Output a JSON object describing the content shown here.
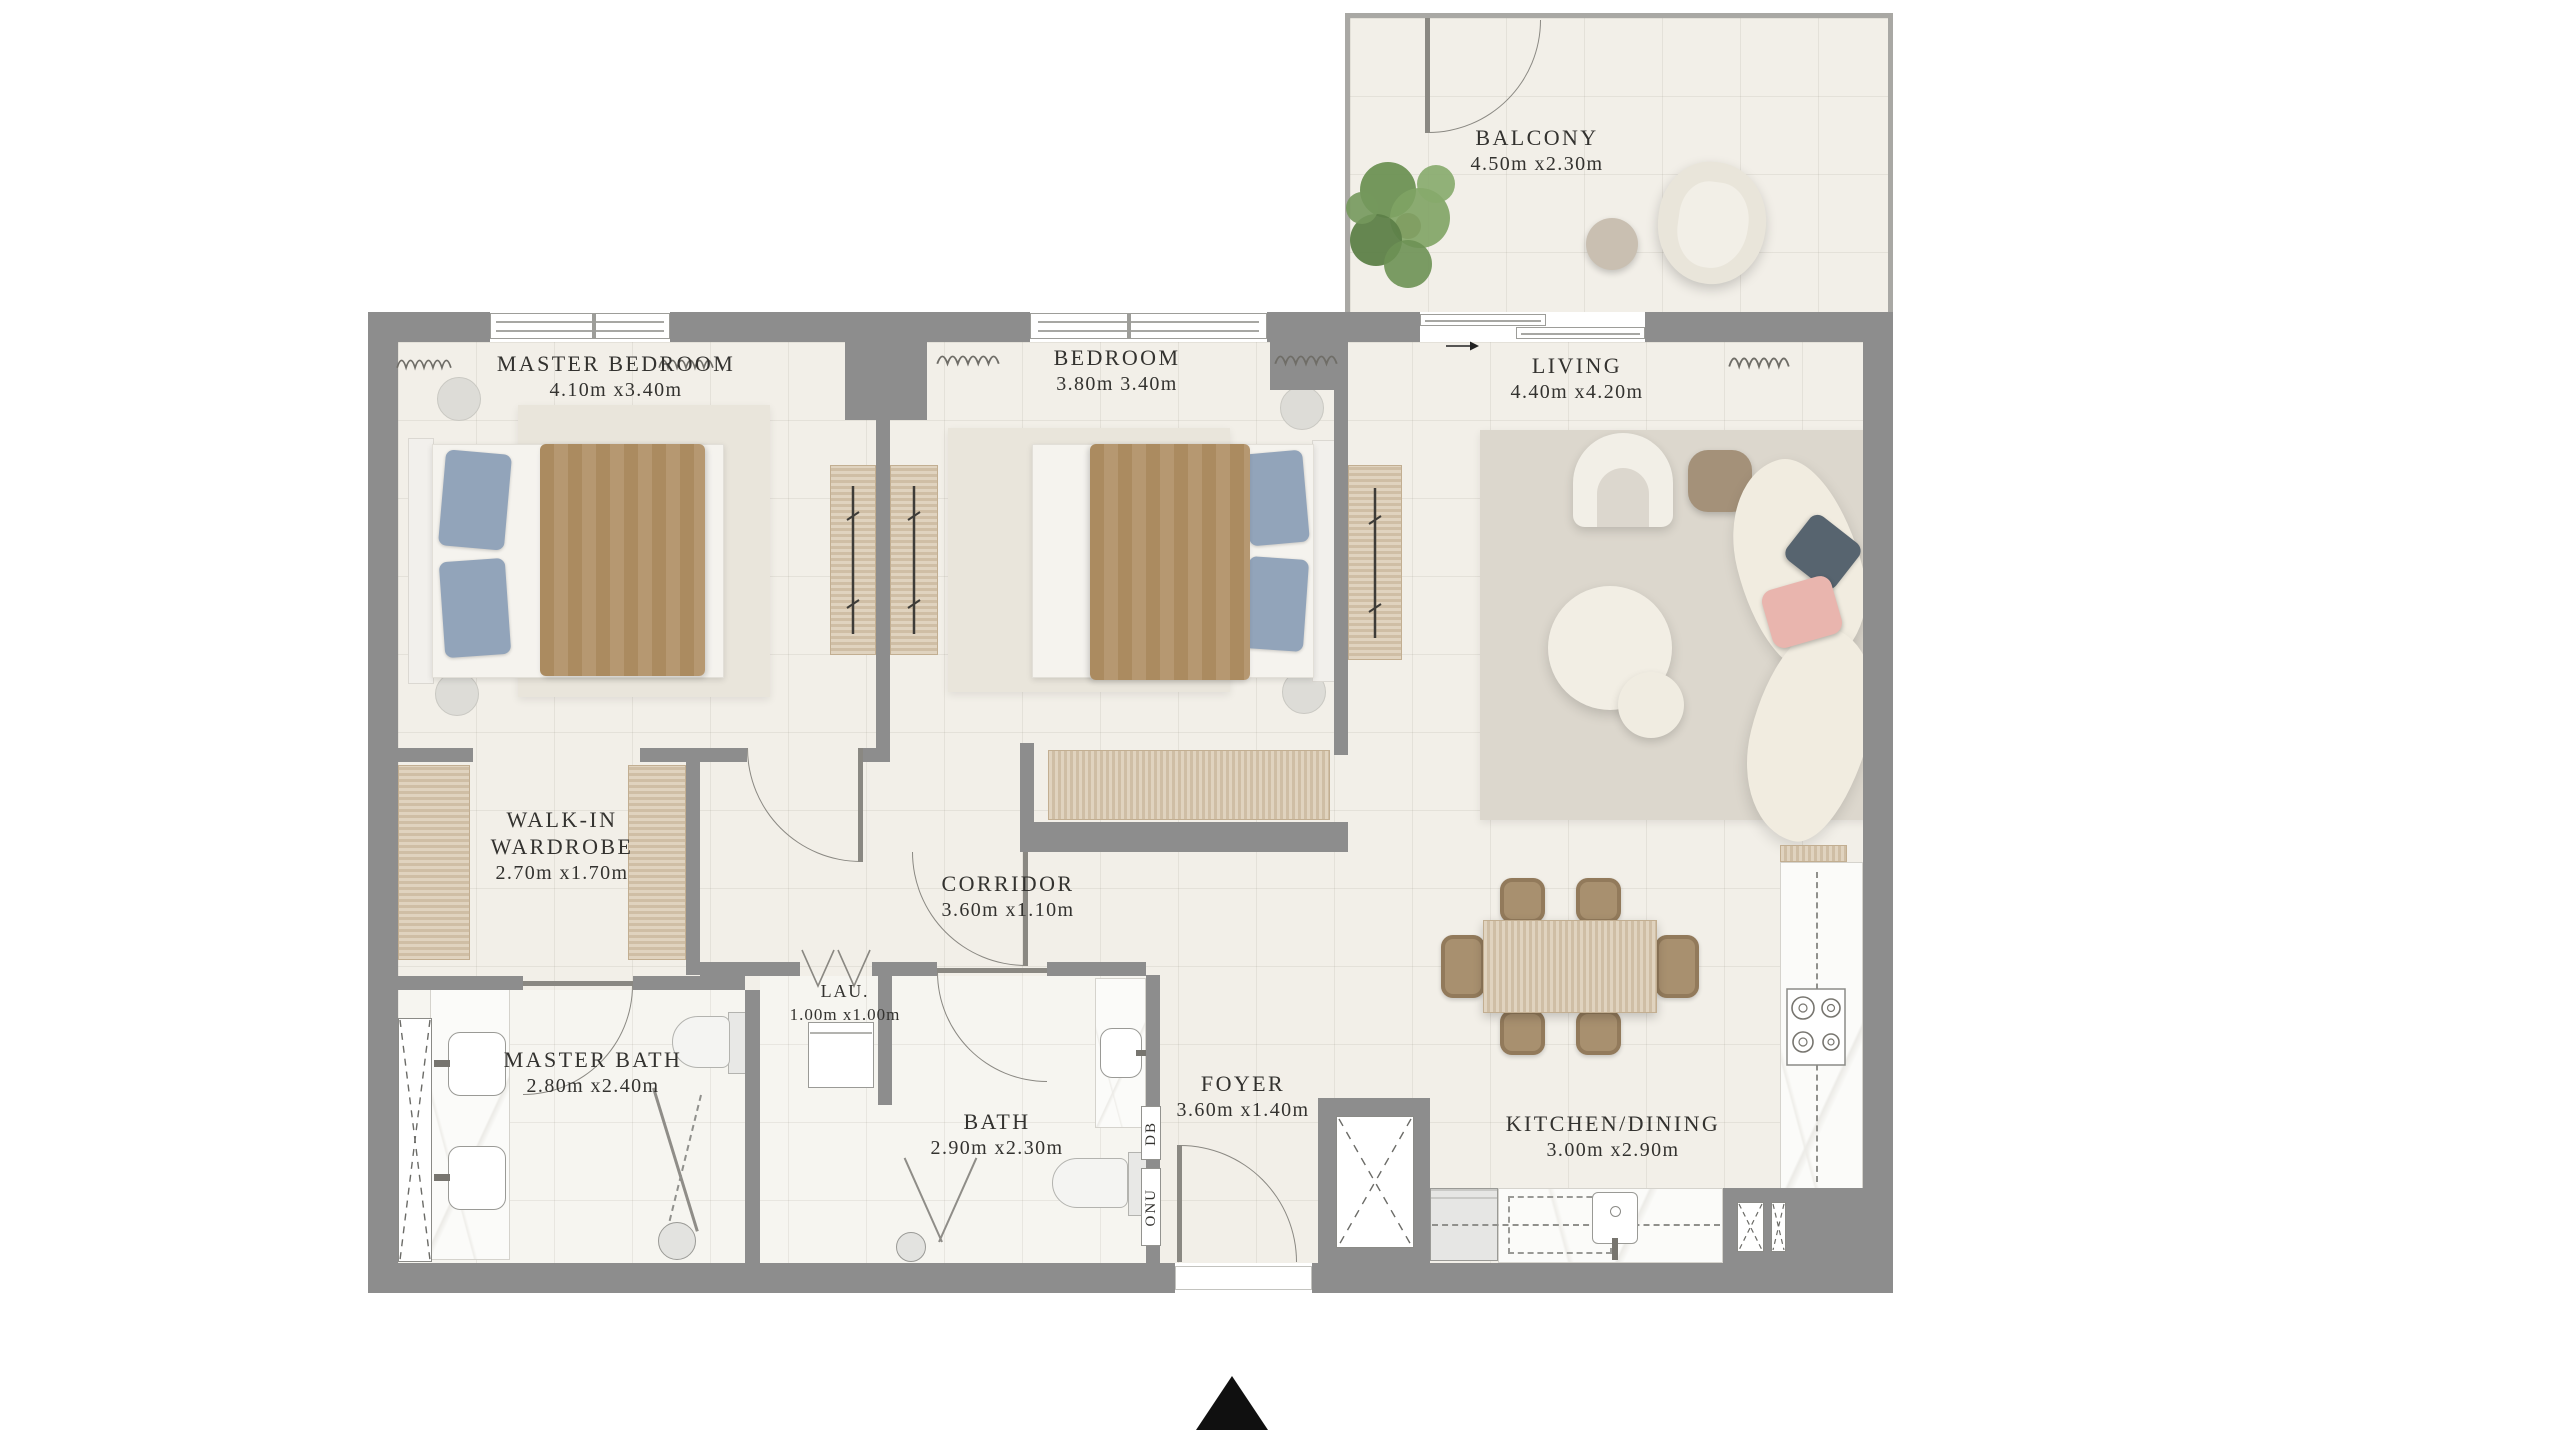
{
  "plan": {
    "title": "Apartment floor plan",
    "rooms": [
      {
        "id": "master-bedroom",
        "name": "MASTER BEDROOM",
        "dims": "4.10m x3.40m"
      },
      {
        "id": "bedroom",
        "name": "BEDROOM",
        "dims": "3.80m 3.40m"
      },
      {
        "id": "living",
        "name": "LIVING",
        "dims": "4.40m x4.20m"
      },
      {
        "id": "balcony",
        "name": "BALCONY",
        "dims": "4.50m x2.30m"
      },
      {
        "id": "walk-in-wardrobe",
        "name": "WALK-IN WARDROBE",
        "dims": "2.70m x1.70m"
      },
      {
        "id": "corridor",
        "name": "CORRIDOR",
        "dims": "3.60m x1.10m"
      },
      {
        "id": "laundry",
        "name": "LAU.",
        "dims": "1.00m x1.00m"
      },
      {
        "id": "master-bath",
        "name": "MASTER BATH",
        "dims": "2.80m x2.40m"
      },
      {
        "id": "bath",
        "name": "BATH",
        "dims": "2.90m x2.30m"
      },
      {
        "id": "foyer",
        "name": "FOYER",
        "dims": "3.60m x1.40m"
      },
      {
        "id": "kitchen-dining",
        "name": "KITCHEN/DINING",
        "dims": "3.00m x2.90m"
      }
    ],
    "utility_labels": {
      "db": "DB",
      "onu": "ONU"
    },
    "colors": {
      "wall": "#8d8d8d",
      "floor": "#f2efe8",
      "wood": "#d6c4aa",
      "marble": "#fbfbf9",
      "rug": "#dcd7cd",
      "blanket": "#ab8b60",
      "pillow_blue": "#92a4ba",
      "pillow_slate": "#57646f",
      "pillow_pink": "#e9b5ae",
      "sofa": "#f1ece0",
      "plant": "#6d9154",
      "text": "#33322f",
      "north_arrow": "#101010"
    }
  }
}
